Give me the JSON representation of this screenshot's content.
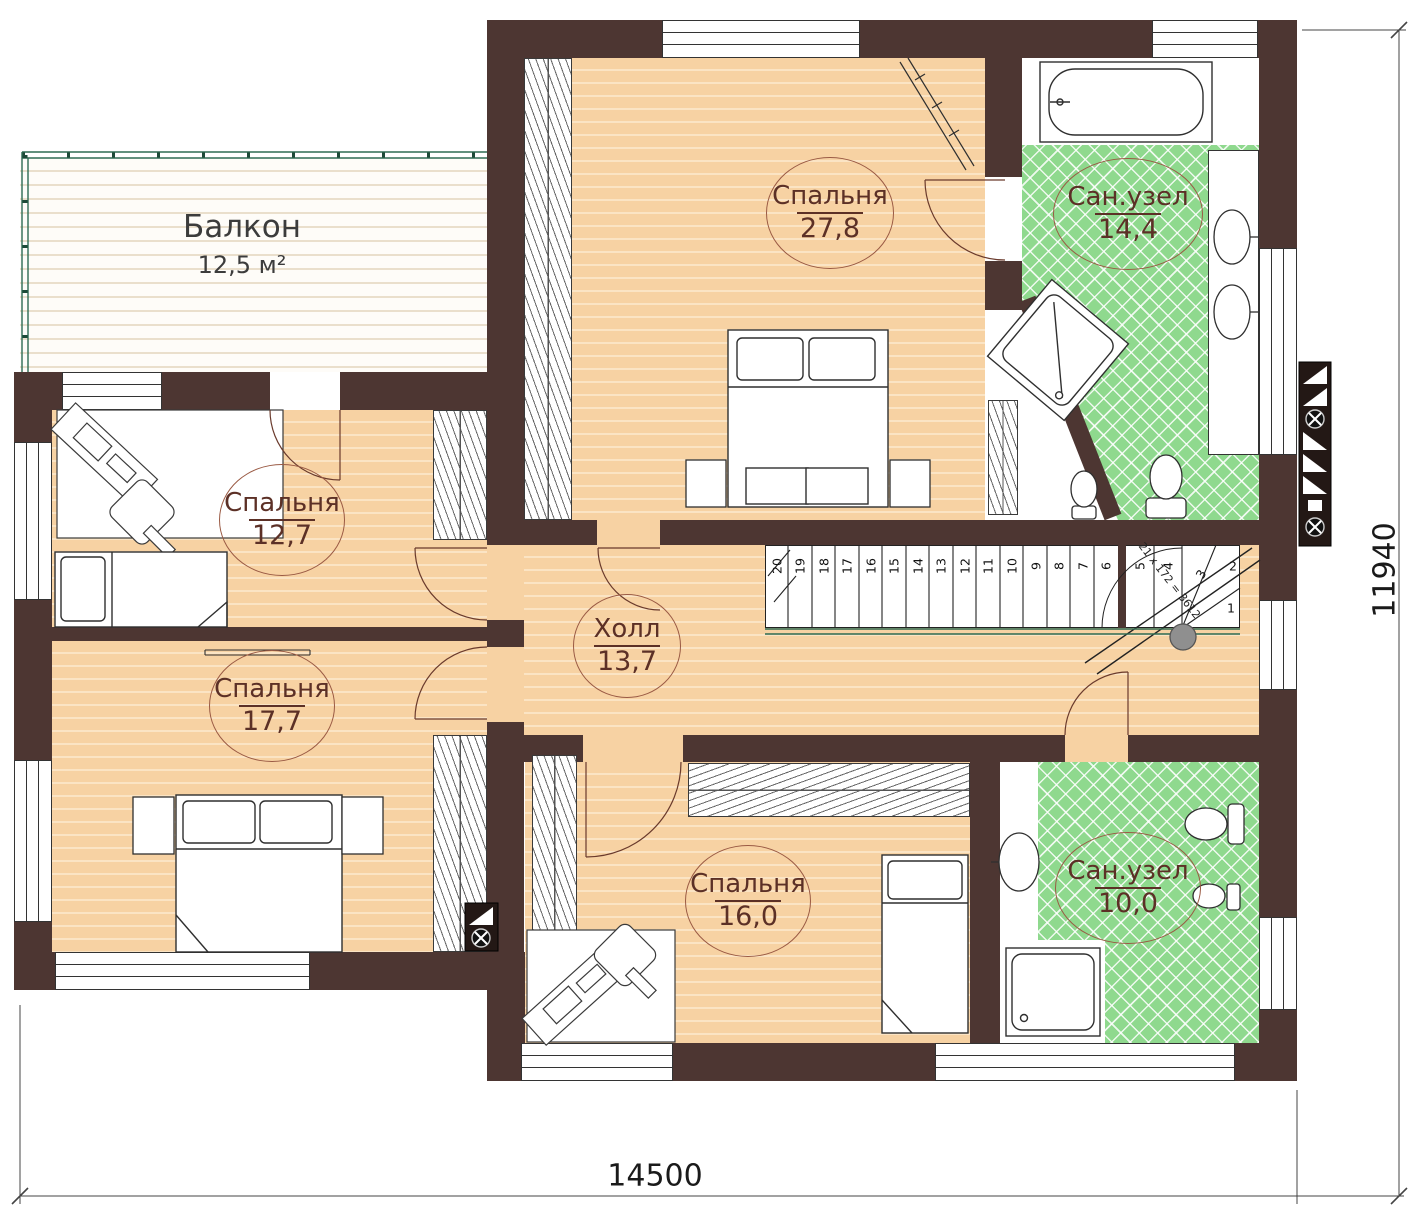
{
  "plan": {
    "rooms": {
      "balcony": {
        "name": "Балкон",
        "area": "12,5 м²"
      },
      "bedroom1": {
        "name": "Спальня",
        "area": "27,8"
      },
      "bath1": {
        "name": "Сан.узел",
        "area": "14,4"
      },
      "bedroom2": {
        "name": "Спальня",
        "area": "12,7"
      },
      "hall": {
        "name": "Холл",
        "area": "13,7"
      },
      "bedroom3": {
        "name": "Спальня",
        "area": "17,7"
      },
      "bedroom4": {
        "name": "Спальня",
        "area": "16,0"
      },
      "bath2": {
        "name": "Сан.узел",
        "area": "10,0"
      }
    },
    "dimensions": {
      "width": "14500",
      "height": "11940"
    },
    "stairs": {
      "treads": [
        "20",
        "19",
        "18",
        "17",
        "16",
        "15",
        "14",
        "13",
        "12",
        "11",
        "10",
        "9",
        "8",
        "7",
        "6",
        "5",
        "4"
      ],
      "winders": [
        "3",
        "2",
        "1"
      ],
      "formula": "21 х 172 = 3612"
    },
    "colors": {
      "wall": "#4d3632",
      "wood": "#f7d2a3",
      "wood_light": "#fbe4c4",
      "tile": "#8fd98e",
      "railing": "#2e6b52",
      "label_ink": "#5c3026"
    }
  }
}
